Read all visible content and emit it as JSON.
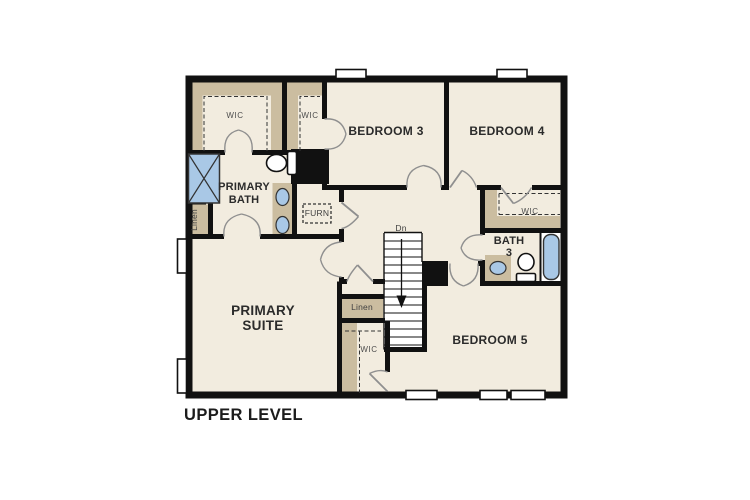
{
  "plan": {
    "title": "UPPER LEVEL",
    "labels": {
      "wic_primary": "WIC",
      "wic_bedroom3": "WIC",
      "bedroom3": "BEDROOM 3",
      "bedroom4": "BEDROOM 4",
      "primary_bath": [
        "PRIMARY",
        "BATH"
      ],
      "linen_bath": "Linen",
      "furnace": "FURN",
      "stairs_down": "Dn",
      "wic_bedroom4": "WIC",
      "bath3": [
        "BATH",
        "3"
      ],
      "primary_suite": [
        "PRIMARY",
        "SUITE"
      ],
      "linen_hall": "Linen",
      "wic_suite": "WIC",
      "bedroom5": "BEDROOM 5"
    },
    "colors": {
      "floor": "#f2ecdf",
      "closet_shelving": "#cbbda0",
      "fixtures_blue": "#a9c8e6",
      "walls": "#111111"
    }
  }
}
